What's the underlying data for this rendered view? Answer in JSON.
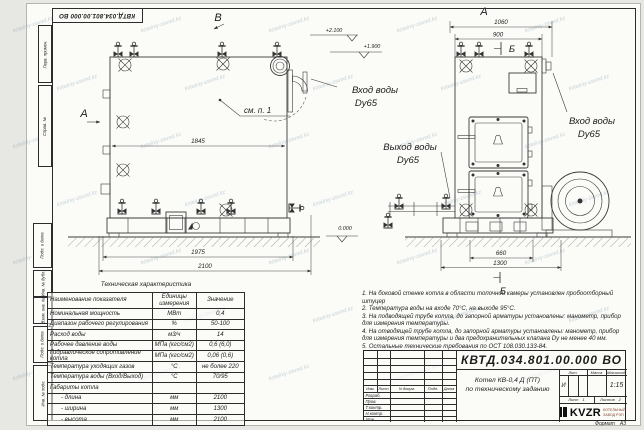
{
  "watermark": "kotelniy-zavod.kz",
  "stamp": {
    "text": "КВТД.034.801.00.000 ВО"
  },
  "frame": {
    "col_top1": "Перв. примен.",
    "col_top2": "Справ. №",
    "col_b1": "Подп. и дата",
    "col_b2": "Инв. № дубл.",
    "col_b3": "Взам. инв. №",
    "col_b4": "Подп. и дата",
    "col_b5": "Инв. № подл.",
    "format_label": "Формат",
    "format_value": "А3"
  },
  "front": {
    "view_label": "В",
    "section_label": "А",
    "callout": "см. п. 1",
    "dim_inner": "1845",
    "dim_base": "1975",
    "dim_overall": "2100"
  },
  "side": {
    "view_label": "А",
    "section_top": "Б",
    "section_bottom": "Б",
    "dim_top_outer": "1060",
    "dim_top_inner": "900",
    "dim_bottom_inner": "660",
    "dim_bottom_outer": "1300"
  },
  "elev": {
    "top": "+2.100",
    "inlet": "+1.900",
    "zero": "0.000"
  },
  "pipes": {
    "inlet_left_line1": "Вход воды",
    "inlet_left_line2": "Dy65",
    "outlet_line1": "Выход воды",
    "outlet_line2": "Dy65",
    "inlet_right_line1": "Вход воды",
    "inlet_right_line2": "Dy65"
  },
  "table": {
    "title": "Техническая характеристика",
    "headers": [
      "Наименование показателя",
      "Единицы измерения",
      "Значение"
    ],
    "rows": [
      {
        "name": "Номинальная мощность",
        "unit": "МВт",
        "value": "0,4"
      },
      {
        "name": "Диапазон рабочего регулирования",
        "unit": "%",
        "value": "50-100"
      },
      {
        "name": "Расход воды",
        "unit": "м3/ч",
        "value": "14"
      },
      {
        "name": "Рабочее давление воды",
        "unit": "МПа (кгс/см2)",
        "value": "0,6 (6,0)"
      },
      {
        "name": "Гидравлическое сопротивление котла",
        "unit": "МПа (кгс/см2)",
        "value": "0,06 (0,6)"
      },
      {
        "name": "Температура уходящих газов",
        "unit": "°С",
        "value": "не более 220"
      },
      {
        "name": "Температура воды (Вход/Выход)",
        "unit": "°С",
        "value": "70/95"
      },
      {
        "name": "Габариты котла",
        "unit": "",
        "value": ""
      },
      {
        "name": "- длина",
        "unit": "мм",
        "value": "2100"
      },
      {
        "name": "- ширина",
        "unit": "мм",
        "value": "1300"
      },
      {
        "name": "- высота",
        "unit": "мм",
        "value": "2100"
      }
    ]
  },
  "notes": {
    "lines": [
      "1.  На боковой стенке котла в области топочной камеры установлен пробоотборный штуцер",
      "2.  Температура воды на входе 70°С, на выходе 95°С.",
      "3.  На подводящей трубе котла, до запорной арматуры установлены: манометр, прибор для измерения температуры.",
      "4.  На отводящей трубе котла, до запорной арматуры установлены: манометр, прибор для измерения температуры и два предохранительных клапана Dу не менее 40 мм.",
      "5.  Остальные технические требования по ОСТ 108.030.133-84."
    ]
  },
  "title_block": {
    "doc_number": "КВТД.034.801.00.000 ВО",
    "name_line1": "Котел КВ-0,4 Д (ПТ)",
    "name_line2": "по техническому заданию",
    "cols": [
      "Изм.",
      "Лист",
      "N докум.",
      "Подп.",
      "Дата"
    ],
    "signs": [
      "Разраб.",
      "Пров.",
      "Т.контр.",
      "Н.контр.",
      "Утв."
    ],
    "lit_header": "Лит.",
    "mass_header": "Масса",
    "scale_header": "Масштаб",
    "lit_value": "И",
    "scale_value": "1:15",
    "sheet_label": "Лист",
    "sheet_value": "1",
    "sheets_label": "Листов",
    "sheets_value": "2",
    "logo_text": "KVZR",
    "logo_cap1": "КОТЕЛЬНЫЙ",
    "logo_cap2": "ЗАВОД РЭП"
  }
}
